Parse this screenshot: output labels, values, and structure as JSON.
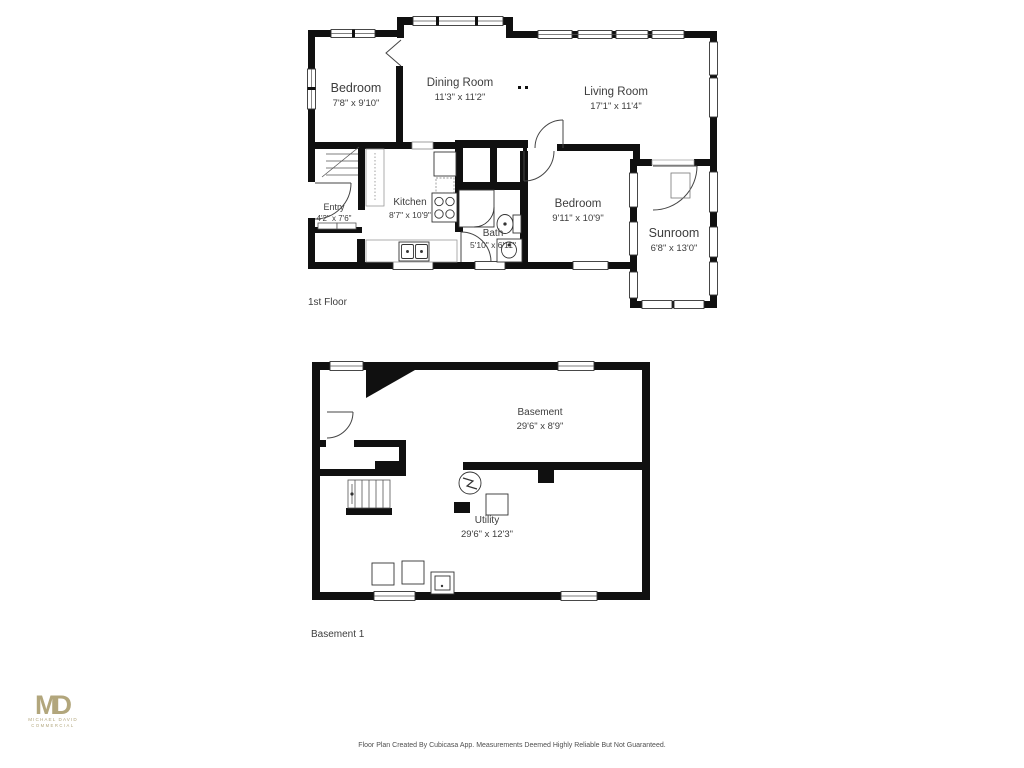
{
  "page": {
    "background": "#ffffff"
  },
  "colors": {
    "wall": "#101010",
    "text": "#3d3d3d",
    "thin_line": "#444444",
    "light_line": "#999999",
    "footer_text": "#4f4f4f"
  },
  "floors": [
    {
      "label": "1st Floor",
      "rooms": [
        {
          "name": "Bedroom",
          "dims": "7'8\" x 9'10\""
        },
        {
          "name": "Dining Room",
          "dims": "11'3\" x 11'2\""
        },
        {
          "name": "Living Room",
          "dims": "17'1\" x 11'4\""
        },
        {
          "name": "Entry",
          "dims": "4'2\" x 7'6\""
        },
        {
          "name": "Kitchen",
          "dims": "8'7\" x 10'9\""
        },
        {
          "name": "Bath",
          "dims": "5'10\" x 6'11\""
        },
        {
          "name": "Bedroom",
          "dims": "9'11\" x 10'9\""
        },
        {
          "name": "Sunroom",
          "dims": "6'8\" x 13'0\""
        }
      ],
      "fixtures": [
        "stairs",
        "tall-cabinet",
        "refrigerator",
        "dishwasher",
        "stove",
        "kitchen-sink",
        "shower",
        "toilet",
        "vanity-sink",
        "closet-doors"
      ]
    },
    {
      "label": "Basement 1",
      "rooms": [
        {
          "name": "Basement",
          "dims": "29'6\" x 8'9\""
        },
        {
          "name": "Utility",
          "dims": "29'6\" x 12'3\""
        }
      ],
      "fixtures": [
        "chimney",
        "stairs",
        "electrical-panel",
        "water-heater",
        "storage-boxes"
      ]
    }
  ],
  "branding": {
    "monogram": "MD",
    "line1": "MICHAEL DAVID",
    "line2": "COMMERCIAL",
    "color": "#b2a67c"
  },
  "footer": {
    "disclaimer": "Floor Plan Created By Cubicasa App. Measurements Deemed Highly Reliable But Not Guaranteed."
  }
}
